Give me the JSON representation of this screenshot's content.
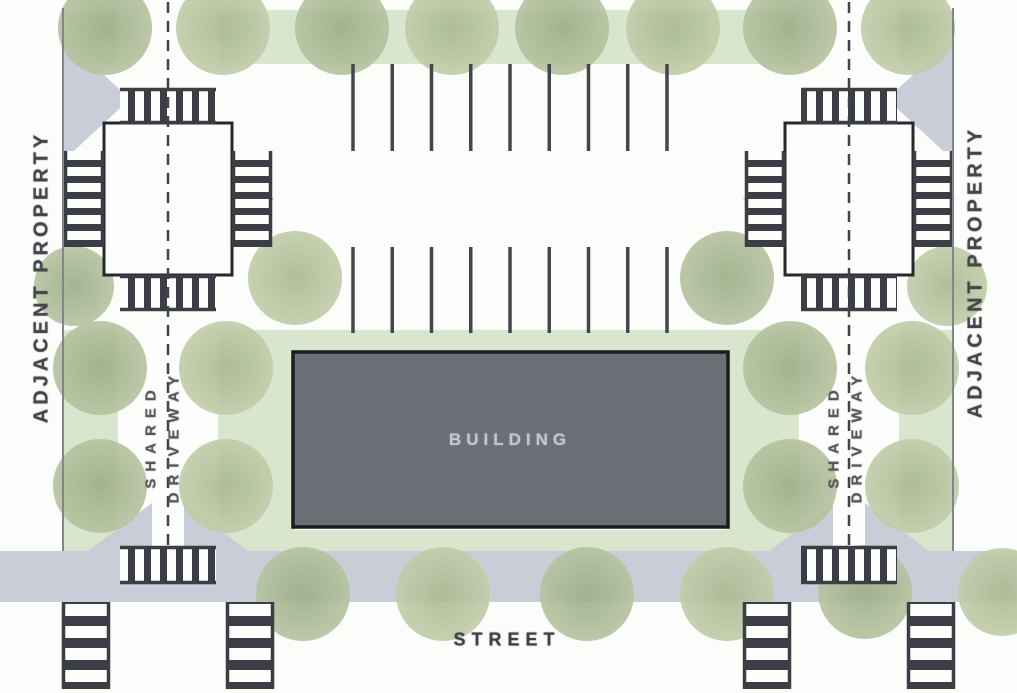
{
  "title": "Site plan diagram",
  "labels": {
    "building": "BUILDING",
    "street": "STREET",
    "adjacent_property_left": "ADJACENT PROPERTY",
    "adjacent_property_right": "ADJACENT PROPERTY",
    "shared_driveway_left": {
      "line1": "SHARED",
      "line2": "DRIVEWAY"
    },
    "shared_driveway_right": {
      "line1": "SHARED",
      "line2": "DRIVEWAY"
    }
  },
  "colors": {
    "background": "#fcfcfb",
    "landscape_strip": "#d9e5cd",
    "tree_inner": "#9fae89",
    "tree_outer": "#b6c3a0",
    "pavement_gray": "#c8cdd7",
    "crosswalk_dark": "#3b3e44",
    "building_fill": "#6b6e75",
    "building_border": "#1a1c1f",
    "building_text": "#c5c8cf",
    "label_text": "#43464c",
    "line_dark": "#3f434a",
    "boundary": "#81868e",
    "paper_white": "#fdfdfc"
  },
  "geometry": {
    "canvas": {
      "w": 1017,
      "h": 693
    },
    "boundaries": [
      {
        "x": 63
      },
      {
        "x": 953
      }
    ],
    "green_rects": [
      [
        63,
        10,
        890,
        54
      ],
      [
        265,
        330,
        492,
        24
      ],
      [
        265,
        352,
        30,
        198
      ],
      [
        727,
        352,
        30,
        198
      ],
      [
        63,
        530,
        890,
        22
      ],
      [
        63,
        330,
        55,
        220
      ],
      [
        218,
        330,
        50,
        220
      ],
      [
        750,
        330,
        49,
        220
      ],
      [
        899,
        330,
        54,
        220
      ]
    ],
    "driveways": [
      {
        "x": 118,
        "y": 0,
        "w": 100,
        "h": 551
      },
      {
        "x": 799,
        "y": 0,
        "w": 100,
        "h": 551
      }
    ],
    "street_band": [
      0,
      551,
      1017,
      51
    ],
    "flares": [
      {
        "cx": 168,
        "cy": 199,
        "s": 150
      },
      {
        "cx": 849,
        "cy": 199,
        "s": 150
      }
    ],
    "wedges": [
      [
        [
          88,
          551
        ],
        [
          152,
          551
        ],
        [
          152,
          503
        ]
      ],
      [
        [
          184,
          551
        ],
        [
          248,
          551
        ],
        [
          184,
          503
        ]
      ],
      [
        [
          769,
          551
        ],
        [
          833,
          551
        ],
        [
          833,
          503
        ]
      ],
      [
        [
          865,
          551
        ],
        [
          929,
          551
        ],
        [
          865,
          503
        ]
      ],
      [
        [
          64,
          38
        ],
        [
          64,
          160
        ],
        [
          130,
          99
        ]
      ],
      [
        [
          953,
          38
        ],
        [
          953,
          160
        ],
        [
          887,
          99
        ]
      ]
    ],
    "tree_radius": 47,
    "trees": [
      [
        105,
        28
      ],
      [
        223,
        28
      ],
      [
        342,
        28
      ],
      [
        452,
        28
      ],
      [
        562,
        28
      ],
      [
        673,
        28
      ],
      [
        790,
        28
      ],
      [
        908,
        28
      ],
      [
        74,
        286,
        40
      ],
      [
        295,
        278
      ],
      [
        727,
        278
      ],
      [
        947,
        286,
        40
      ],
      [
        100,
        368
      ],
      [
        226,
        368
      ],
      [
        100,
        486
      ],
      [
        226,
        486
      ],
      [
        790,
        368
      ],
      [
        912,
        368
      ],
      [
        790,
        486
      ],
      [
        912,
        486
      ],
      [
        303,
        594
      ],
      [
        443,
        594
      ],
      [
        587,
        594
      ],
      [
        727,
        594
      ],
      [
        865,
        592
      ],
      [
        1002,
        592,
        44
      ]
    ],
    "parking": {
      "x_start": 353,
      "x_end": 667,
      "lines": 9,
      "rows": [
        [
          64,
          151
        ],
        [
          247,
          333
        ]
      ]
    },
    "intersections": [
      {
        "x": 104,
        "y": 123,
        "w": 128,
        "h": 152
      },
      {
        "x": 785,
        "y": 123,
        "w": 128,
        "h": 152
      }
    ],
    "crosswalks": [
      {
        "x": 120,
        "y": 88,
        "w": 96,
        "h": 36,
        "dir": "v"
      },
      {
        "x": 120,
        "y": 275,
        "w": 96,
        "h": 36,
        "dir": "v"
      },
      {
        "x": 64,
        "y": 151,
        "w": 40,
        "h": 96,
        "dir": "h"
      },
      {
        "x": 232,
        "y": 151,
        "w": 40,
        "h": 96,
        "dir": "h"
      },
      {
        "x": 801,
        "y": 88,
        "w": 96,
        "h": 36,
        "dir": "v"
      },
      {
        "x": 801,
        "y": 275,
        "w": 96,
        "h": 36,
        "dir": "v"
      },
      {
        "x": 745,
        "y": 151,
        "w": 40,
        "h": 96,
        "dir": "h"
      },
      {
        "x": 913,
        "y": 151,
        "w": 40,
        "h": 96,
        "dir": "h"
      },
      {
        "x": 120,
        "y": 546,
        "w": 96,
        "h": 38,
        "dir": "v"
      },
      {
        "x": 801,
        "y": 546,
        "w": 96,
        "h": 38,
        "dir": "v"
      },
      {
        "x": 62,
        "y": 602,
        "w": 48,
        "h": 87,
        "dir": "hb"
      },
      {
        "x": 226,
        "y": 602,
        "w": 48,
        "h": 87,
        "dir": "hb"
      },
      {
        "x": 743,
        "y": 602,
        "w": 48,
        "h": 87,
        "dir": "hb"
      },
      {
        "x": 907,
        "y": 602,
        "w": 48,
        "h": 87,
        "dir": "hb"
      }
    ],
    "center_dashes": [
      {
        "x": 168,
        "y1": 2,
        "y2": 546
      },
      {
        "x": 849,
        "y1": 2,
        "y2": 546
      }
    ],
    "building": {
      "x": 293,
      "y": 352,
      "w": 435,
      "h": 175
    }
  }
}
